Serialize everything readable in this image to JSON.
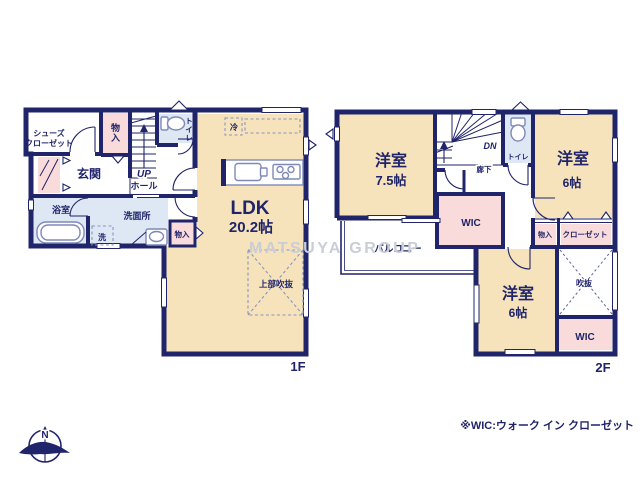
{
  "watermark": "MATSUYA GROUP",
  "footnote": "※WIC:ウォーク イン クローゼット",
  "compass": {
    "north_label": "N"
  },
  "colors": {
    "wall_navy": "#20246a",
    "room_tan": "#f6e3bb",
    "closet_pink": "#f8dbda",
    "wet_area_blue": "#dde8f4",
    "watermark_gray": "#c9cdd6"
  },
  "floor1": {
    "label": "1F",
    "ldk": {
      "name": "LDK",
      "size": "20.2帖"
    },
    "shoes_closet": {
      "line1": "シューズ",
      "line2": "クローゼット"
    },
    "entrance": "玄関",
    "hall": "ホール",
    "stairs": "UP",
    "storage_upper": "物入",
    "toilet": "トイレ",
    "bathroom": "浴室",
    "washroom": "洗面所",
    "laundry": "洗",
    "storage_side": "物入",
    "fridge": "冷",
    "open_ceiling": "上部吹抜"
  },
  "floor2": {
    "label": "2F",
    "bedroom_west": {
      "name": "洋室",
      "size": "7.5帖"
    },
    "bedroom_east": {
      "name": "洋室",
      "size": "6帖"
    },
    "bedroom_south": {
      "name": "洋室",
      "size": "6帖"
    },
    "stairs": "DN",
    "corridor": "廊下",
    "toilet": "トイレ",
    "wic_center": "WIC",
    "wic_south": "WIC",
    "storage": "物入",
    "closet": "クローゼット",
    "balcony": "バルコニー",
    "void": "吹抜"
  }
}
